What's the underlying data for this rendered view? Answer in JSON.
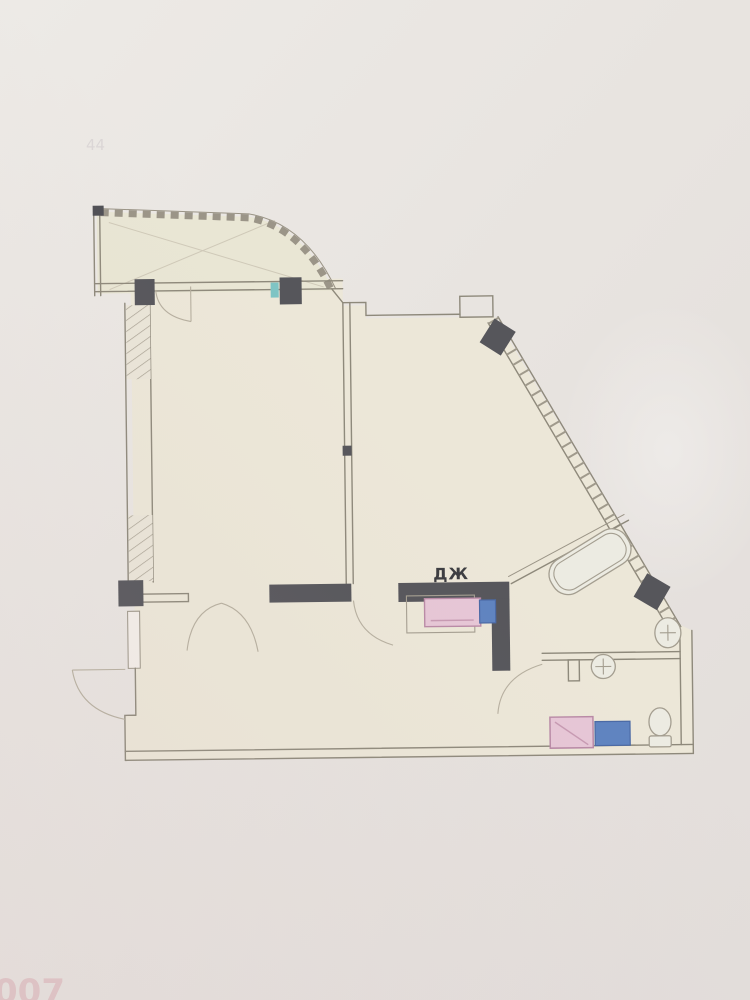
{
  "photo": {
    "watermark_text": "007",
    "smudge_text": "44"
  },
  "floorplan": {
    "room_label": "ДЖ",
    "colors": {
      "paper_background": "#e8e4e0",
      "floor_fill": "#ece7d8",
      "balcony_fill": "#e9e6d4",
      "wall_line": "#8e897b",
      "wall_dark": "#56565b",
      "hatch": "#a39d8e",
      "appliance_pink": "#e6c6d6",
      "appliance_pink_border": "#b98aa6",
      "appliance_blue": "#5f83c0",
      "accent_teal": "#7fc4c4",
      "fixture_fill": "#ecebe2",
      "watermark_pink": "#d8a0aa"
    },
    "fixtures": [
      {
        "name": "balcony"
      },
      {
        "name": "bathtub"
      },
      {
        "name": "corner-sink"
      },
      {
        "name": "wc-sink"
      },
      {
        "name": "toilet"
      },
      {
        "name": "washing-machine"
      },
      {
        "name": "stove-unit"
      },
      {
        "name": "blue-unit"
      }
    ]
  }
}
